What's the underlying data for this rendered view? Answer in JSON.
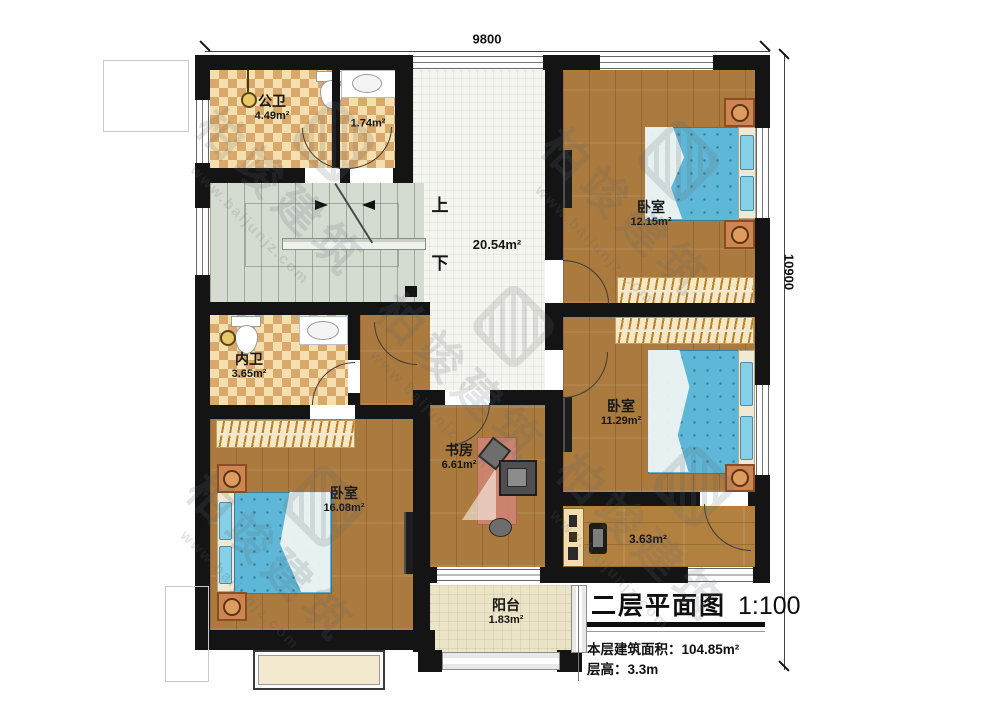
{
  "dimensions": {
    "width": "9800",
    "height": "10900"
  },
  "stairs": {
    "up": "上",
    "down": "下"
  },
  "rooms": [
    {
      "name": "公卫",
      "area": "4.49m²"
    },
    {
      "name": "",
      "area": "1.74m²"
    },
    {
      "name": "",
      "area": "20.54m²"
    },
    {
      "name": "卧室",
      "area": "12.15m²"
    },
    {
      "name": "内卫",
      "area": "3.65m²"
    },
    {
      "name": "卧室",
      "area": "11.29m²"
    },
    {
      "name": "书房",
      "area": "6.61m²"
    },
    {
      "name": "卧室",
      "area": "16.08m²"
    },
    {
      "name": "",
      "area": "3.63m²"
    },
    {
      "name": "阳台",
      "area": "1.83m²"
    }
  ],
  "title_block": {
    "title": "二层平面图",
    "scale": "1:100",
    "area_label": "本层建筑面积：",
    "area_value": "104.85m²",
    "floor_height_label": "层高：",
    "floor_height_value": "3.3m"
  },
  "watermark": {
    "brand": "柏竣建筑",
    "url": "www.baijunjz.com"
  },
  "colors": {
    "wall": "#141414",
    "wood": "#ab7a3f",
    "checker_light": "#f6dfae",
    "checker_dark": "#d9a96b",
    "hall_tile": "#f5f5ef",
    "stair": "#d4dcd2",
    "bed_blue": "#5fb7d8",
    "pillow_blue": "#86cfe8",
    "nightstand": "#cd8551",
    "wardrobe": "#f7e8c4",
    "balcony_tile": "#ece4c6",
    "rug": "#ce8472"
  }
}
